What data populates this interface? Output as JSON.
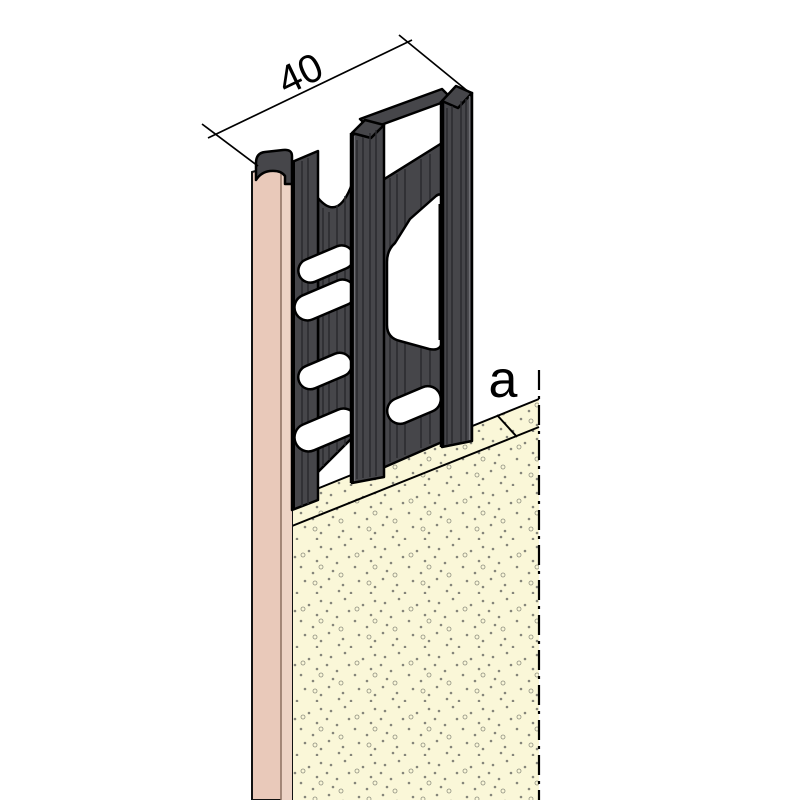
{
  "title": "plaster-stop-profile-isometric-diagram",
  "labels": {
    "width_dimension": "40",
    "plaster_thickness": "a"
  },
  "colors": {
    "background": "#ffffff",
    "profile": "#46464A",
    "profile_groove": "#2A2A2E",
    "profile_highlight": "#6E6E73",
    "board_face": "#E9C9BA",
    "board_side": "#EDD3C5",
    "board_inner_line": "#8B6F60",
    "plaster": "#FAF7D8",
    "stipple": "#85857A",
    "outline": "#000000"
  }
}
